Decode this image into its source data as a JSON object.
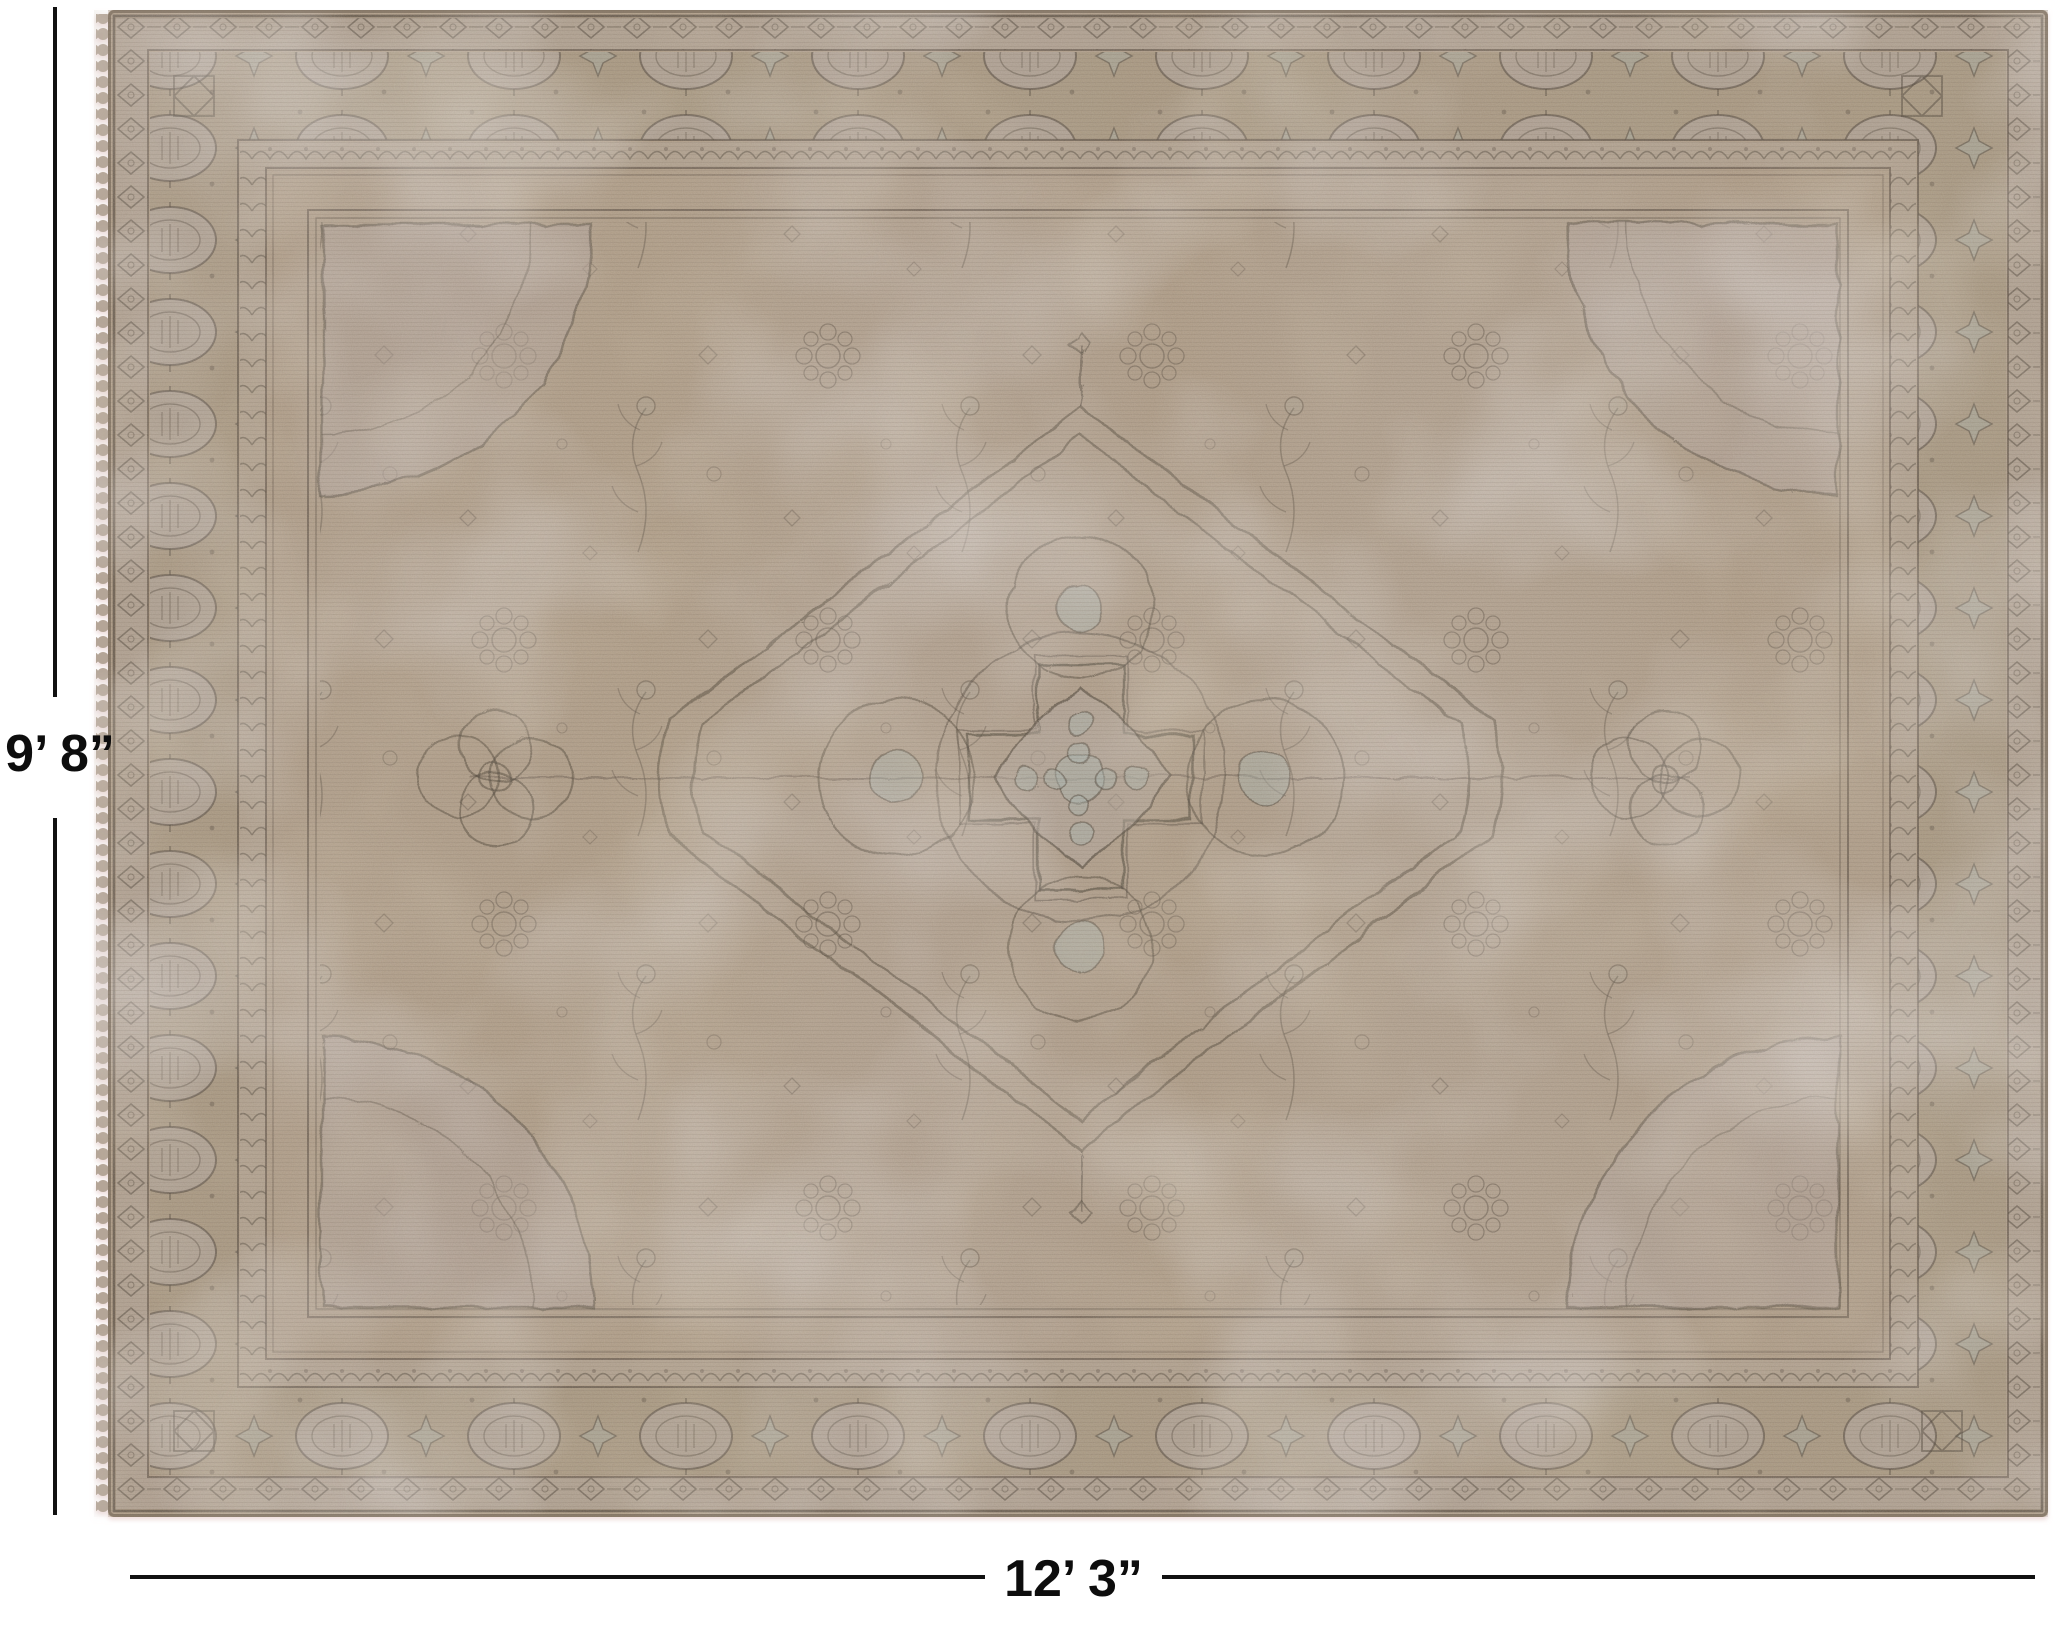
{
  "image": {
    "kind": "product-photo",
    "subject": "Vintage hand-knotted overdyed Persian-style area rug with center medallion, shown flat on white background with size annotations"
  },
  "dimensions": {
    "height_label": "9’ 8”",
    "width_label": "12’ 3”"
  },
  "annotation": {
    "line_color": "#111111",
    "text_color": "#0d0d0d"
  },
  "rug_palette": {
    "field_tan": "#b19f8a",
    "wash_grey": "#bcb0ac",
    "border_tan": "#a8977f",
    "guard_band": "#b1a395",
    "outline_ink": "#4a4034",
    "accent_blue_grey": "#a9b4ae",
    "fringe": "#b4a597",
    "shadow_pink": "#e4c8c6"
  }
}
